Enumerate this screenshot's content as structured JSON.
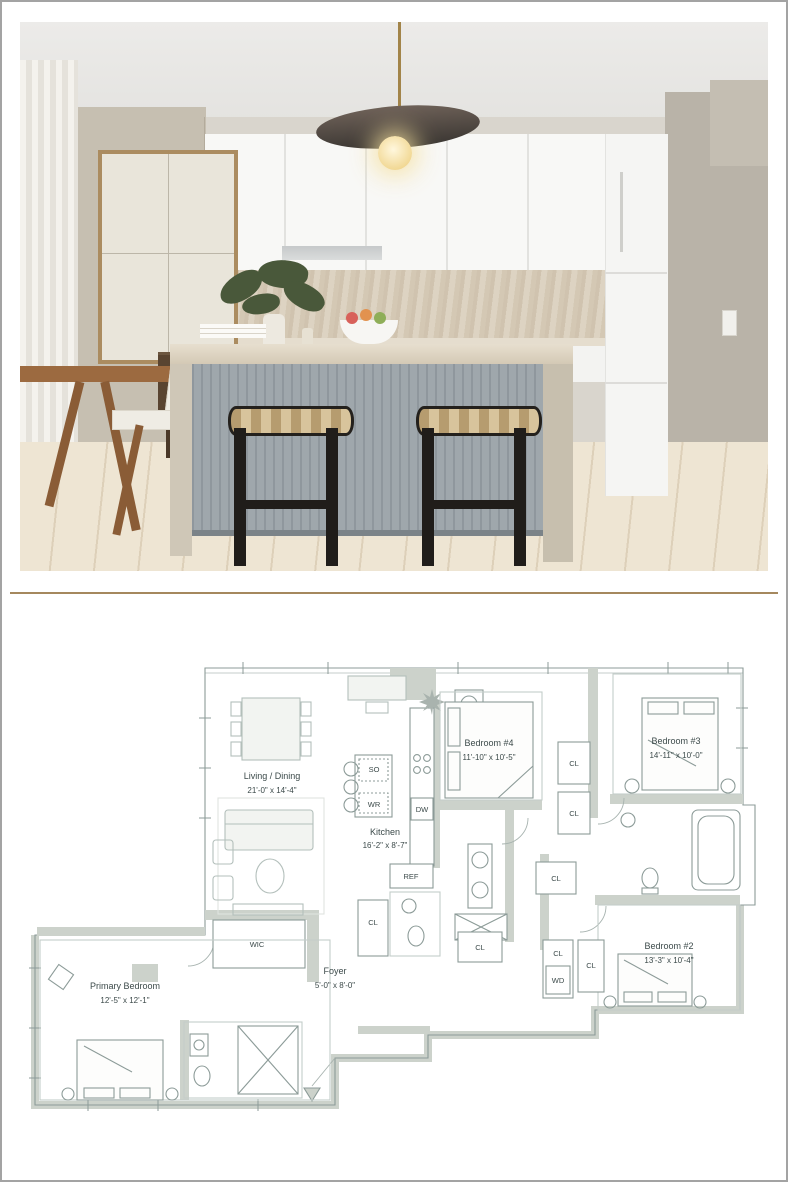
{
  "window": {
    "bg": "#ffffff",
    "frame_border": "#a3a3a3",
    "divider_color": "#a5885e"
  },
  "photo": {
    "name": "kitchen-photo"
  },
  "floorplan": {
    "rooms": {
      "living": {
        "name": "Living / Dining",
        "dims": "21'-0\" x 14'-4\""
      },
      "kitchen": {
        "name": "Kitchen",
        "dims": "16'-2\" x 8'-7\""
      },
      "bedroom4": {
        "name": "Bedroom #4",
        "dims": "11'-10\" x 10'-5\""
      },
      "bedroom3": {
        "name": "Bedroom #3",
        "dims": "14'-11\" x 10'-0\""
      },
      "bedroom2": {
        "name": "Bedroom #2",
        "dims": "13'-3\" x 10'-4\""
      },
      "primary": {
        "name": "Primary Bedroom",
        "dims": "12'-5\" x 12'-1\""
      },
      "foyer": {
        "name": "Foyer",
        "dims": "5'-0\" x 8'-0\""
      }
    },
    "labels": {
      "wic": "WIC",
      "cl": "CL",
      "wd": "WD",
      "so": "SO",
      "wr": "WR",
      "dw": "DW",
      "ref": "REF"
    },
    "colors": {
      "wall_fill": "#ccd2cb",
      "line": "#8c9b98",
      "furniture_line": "#b3bfbb",
      "text": "#3c4a4a"
    }
  }
}
